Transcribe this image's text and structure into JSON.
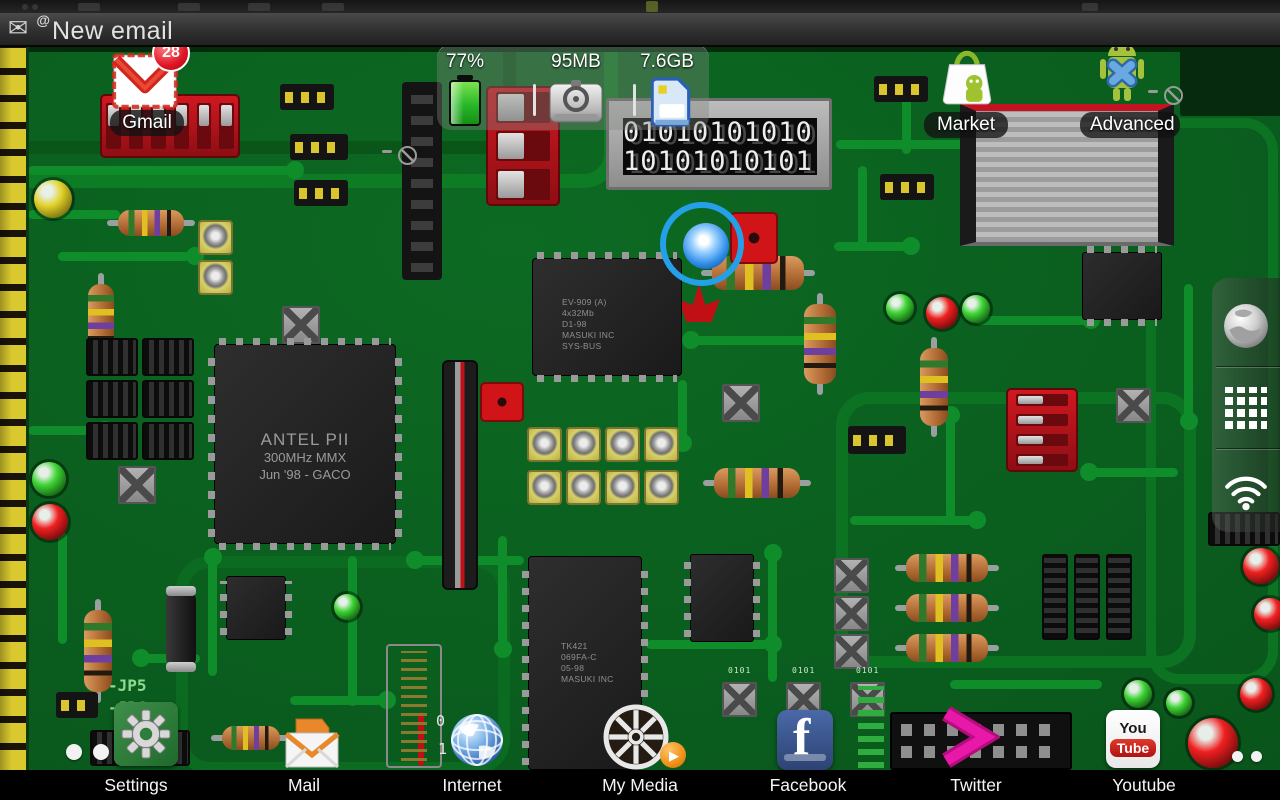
{
  "status_bar": {
    "notification_text": "New email",
    "envelope_icon": "✉",
    "at_symbol": "@"
  },
  "widgets": {
    "status_panel": {
      "battery_pct": "77%",
      "memory": "95MB",
      "storage": "7.6GB"
    },
    "gmail": {
      "label": "Gmail",
      "badge": "28"
    },
    "market": {
      "label": "Market"
    },
    "advanced_task": {
      "label": "Advanced Tas"
    }
  },
  "dock": {
    "items": [
      {
        "label": "Settings"
      },
      {
        "label": "Mail"
      },
      {
        "label": "Internet"
      },
      {
        "label": "My Media"
      },
      {
        "label": "Facebook"
      },
      {
        "label": "Twitter"
      },
      {
        "label": "Youtube"
      }
    ]
  },
  "sidebar": {
    "icons": [
      "globe",
      "apps-grid",
      "wifi"
    ]
  },
  "wallpaper": {
    "cpu_chip": {
      "line1": "ANTEL PII",
      "line2": "300MHz MMX",
      "line3": "Jun '98 - GACO"
    },
    "ram_chip": {
      "line1": "EV-909 (A)",
      "line2": "4x32Mb",
      "line3": "D1-98",
      "line4": "MASUKI INC",
      "line5": "SYS-BUS"
    },
    "tk_chip": {
      "line1": "TK421",
      "line2": "069FA-C",
      "line3": "05-98",
      "line4": "MASUKI INC"
    },
    "binary_display": {
      "row1": "01010101010",
      "row2": "10101010101"
    },
    "jumper_label_1": "-JP5",
    "jumper_label_2": "-JP6",
    "switch_label_0": "0",
    "switch_label_1": "1",
    "tiny_binary": "0101"
  },
  "icons": {
    "facebook_letter": "f",
    "youtube_top": "You",
    "youtube_bottom": "Tube"
  },
  "page_dots": {
    "left_count": 2,
    "right_count": 2
  },
  "colors": {
    "board_green": "#0a5e1e",
    "trace_green": "#0f8d2a",
    "accent_blue": "#25a0e8",
    "badge_red": "#e01525",
    "twitter_pink": "#e0109c",
    "dock_black": "#000000",
    "label_text": "#f5f5f5"
  }
}
